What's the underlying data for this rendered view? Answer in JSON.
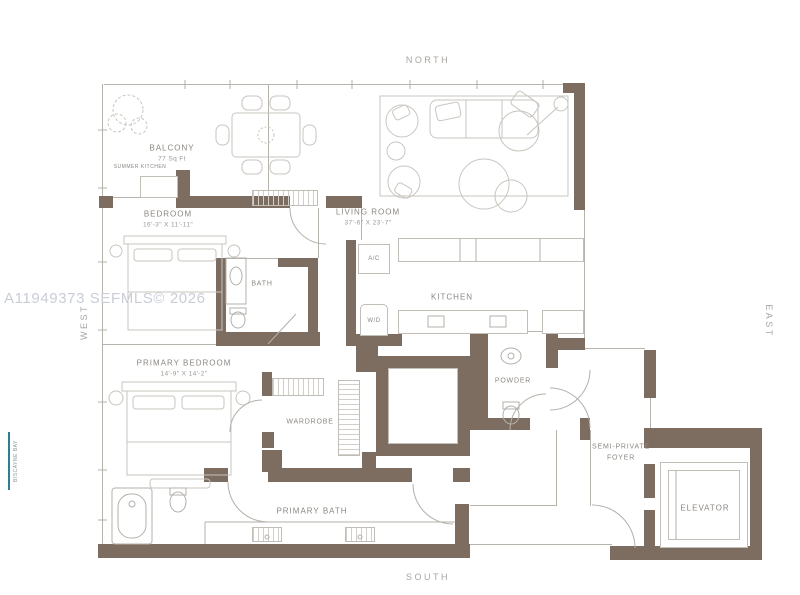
{
  "watermark": "A11949373 SEFMLS© 2026",
  "shoreline_label": "BISCAYNE BAY",
  "compass": {
    "north": "NORTH",
    "south": "SOUTH",
    "east": "EAST",
    "west": "WEST"
  },
  "rooms": {
    "balcony": {
      "name": "BALCONY",
      "area": "77 Sq Ft"
    },
    "summer_kitchen": {
      "name": "SUMMER KITCHEN"
    },
    "bedroom": {
      "name": "BEDROOM",
      "dims": "16'-3\" X 11'-11\""
    },
    "living_room": {
      "name": "LIVING ROOM",
      "dims": "37'-6\" X 23'-7\""
    },
    "bath": {
      "name": "BATH"
    },
    "ac": {
      "name": "A/C"
    },
    "wd": {
      "name": "W/D"
    },
    "kitchen": {
      "name": "KITCHEN"
    },
    "powder": {
      "name": "POWDER"
    },
    "wardrobe": {
      "name": "WARDROBE"
    },
    "primary_bedroom": {
      "name": "PRIMARY BEDROOM",
      "dims": "14'-9\" X 14'-2\""
    },
    "primary_bath": {
      "name": "PRIMARY BATH"
    },
    "foyer": {
      "name": "SEMI-PRIVATE FOYER",
      "line1": "SEMI-PRIVATE",
      "line2": "FOYER"
    },
    "elevator": {
      "name": "ELEVATOR"
    }
  },
  "colors": {
    "wall": "#7d6c60",
    "thin_line": "#b6b2ac",
    "furniture_line": "#c9c5bf",
    "label_text": "#8b8781",
    "watermark_text": "#c9cdd6",
    "bay_accent": "#2b7f8f"
  }
}
